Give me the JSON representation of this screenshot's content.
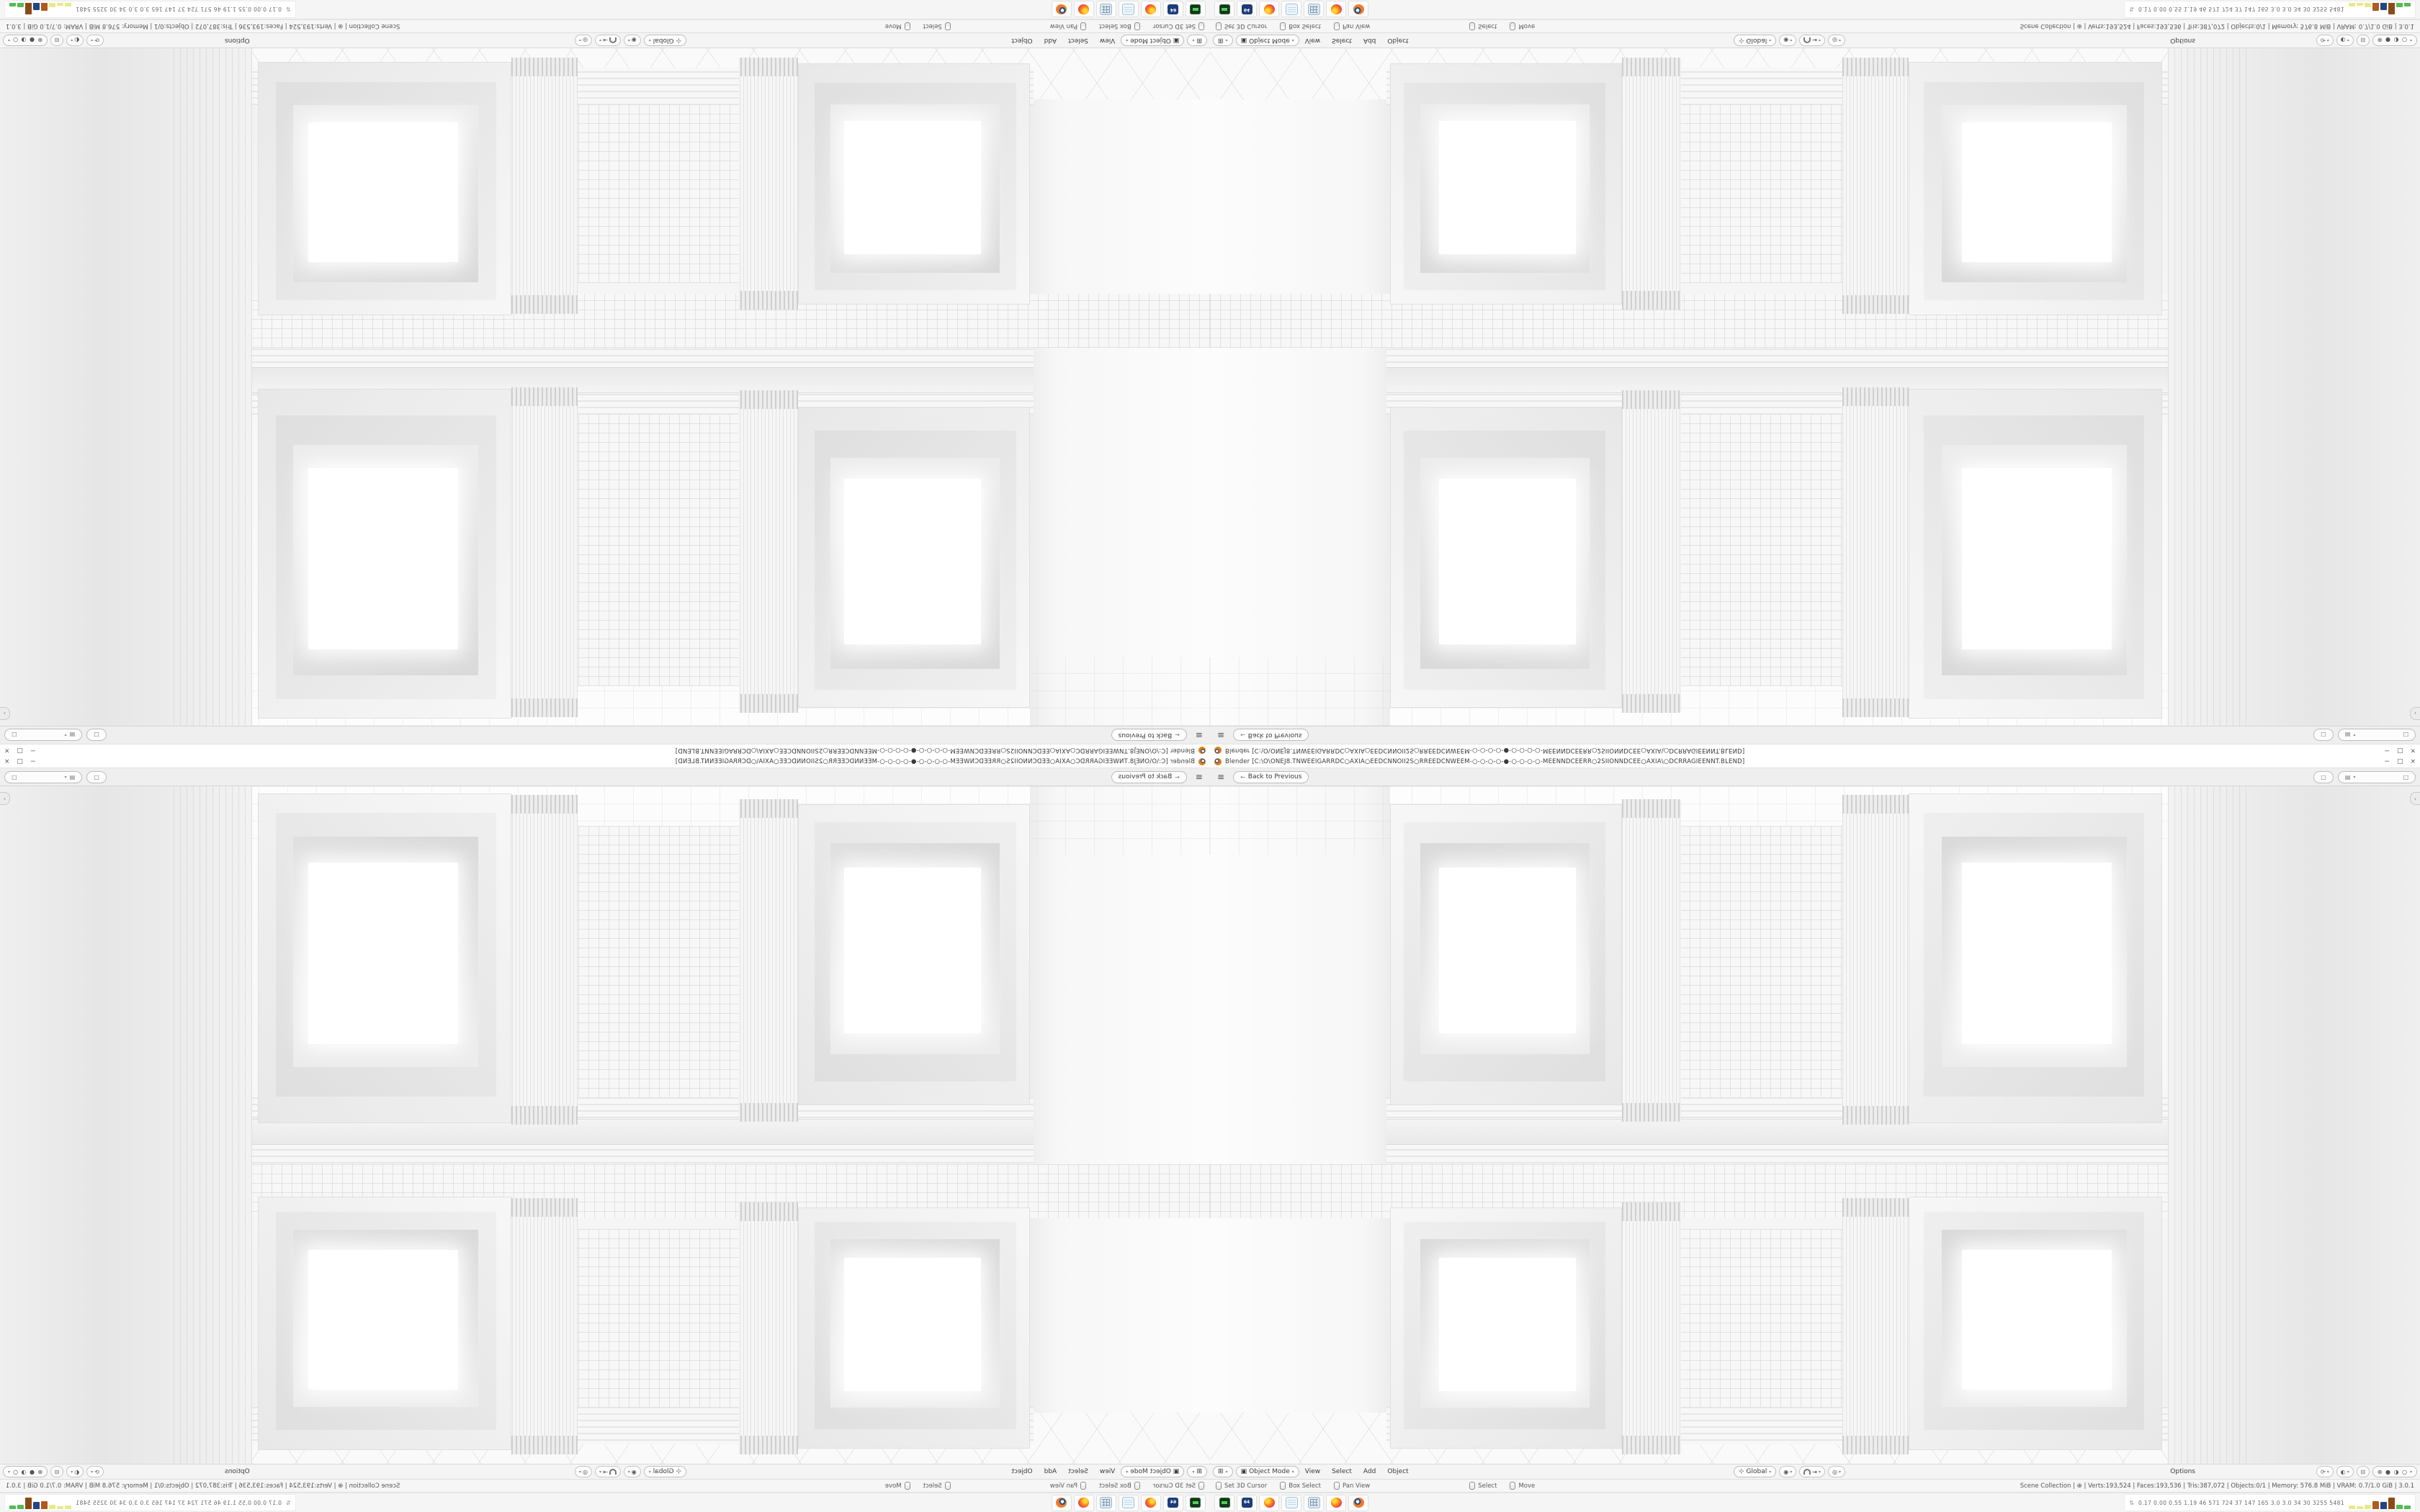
{
  "title_bar": {
    "title": "Blender [C:\\O\\ONEJ8.TNWEEIGARRDC○AXIA○EEDCNNOII2S○RREEDCNWEEM-○-○-○-○-●-○-○-○-○-MEENNDCEERR○2SIIONNDCEE○AXIA\\○DCRRAGIEENNT.BLEND]",
    "minimize": "−",
    "restore": "□",
    "close": "×"
  },
  "topbar": {
    "back_label": "Back to Previous"
  },
  "viewport": {
    "sidebar_toggle": "‹"
  },
  "header": {
    "mode_label": "Object Mode",
    "menus": [
      "View",
      "Select",
      "Add",
      "Object"
    ],
    "orientation_label": "Global",
    "options_label": "Options",
    "shading_modes": "⊕ ● ◑ ○"
  },
  "status_bar": {
    "hints": [
      "Set 3D Cursor",
      "Box Select",
      "Pan View",
      "Select",
      "Move"
    ],
    "stats": "Scene Collection  |  ⊕  |  Verts:193,524  |  Faces:193,536  |  Tris:387,072  |  Objects:0/1  |  Memory: 576.8 MiB  |  VRAM: 0.7/1.0 GiB  |  3.0.1"
  },
  "taskbar": {
    "apps": [
      "terminal",
      "7zip",
      "firefox",
      "notepad",
      "calculator",
      "firefox",
      "blender"
    ],
    "stats_text": "0.17 0.00 0.55 1.19   46   571   724   37   147   165   3.0   3.0   34   30   3255 5481",
    "bars": [
      {
        "color": "#e9e98c",
        "h": 5
      },
      {
        "color": "#e9e98c",
        "h": 4
      },
      {
        "color": "#e9e98c",
        "h": 6
      },
      {
        "color": "#b05a1f",
        "h": 11
      },
      {
        "color": "#23457f",
        "h": 10
      },
      {
        "color": "#8a4a16",
        "h": 16
      },
      {
        "color": "#57b957",
        "h": 6
      },
      {
        "color": "#57b957",
        "h": 5
      }
    ]
  },
  "icons": {
    "hamburger": "≡",
    "back_arrow": "←",
    "chevron": "▾",
    "editor_type": "⊞",
    "mode_icon": "▣",
    "orientation_icon": "⊹",
    "pivot_icon": "◉",
    "snap_target": "⇥",
    "proportional_icon": "◎",
    "gizmo_icon": "⟳",
    "overlays_icon": "◐",
    "xray_icon": "⊟",
    "scene_icon": "□",
    "viewlayer_icon": "▤",
    "stats_arrows": "⇅",
    "globe": "⊕"
  },
  "accent_colors": {
    "blender_orange": "#e87d0d",
    "graph_green": "#57b957",
    "graph_blue": "#23457f",
    "graph_brown": "#8a4a16",
    "graph_yellow": "#e9e98c"
  }
}
